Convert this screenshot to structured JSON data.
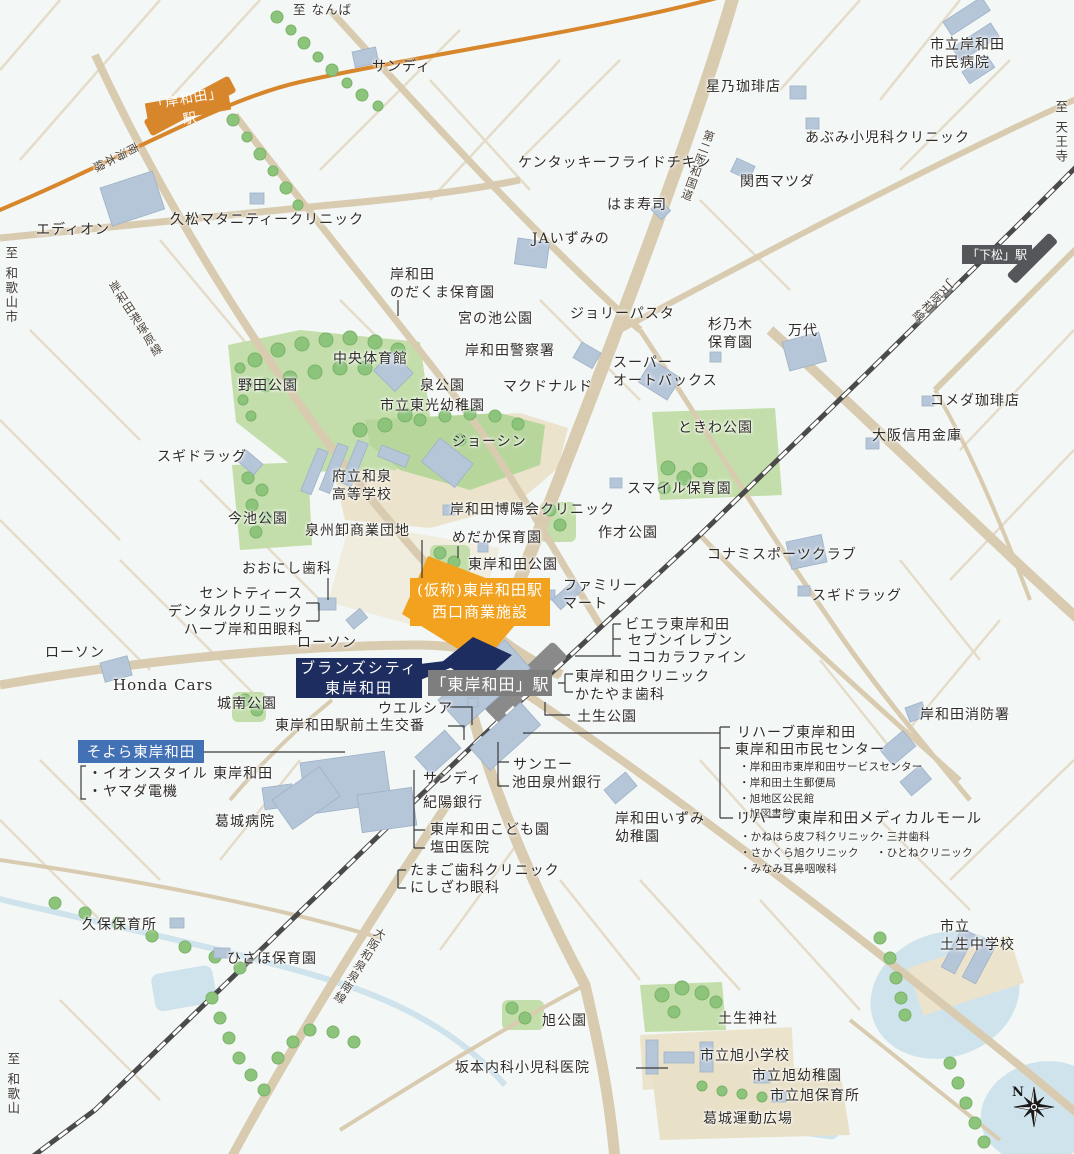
{
  "stations": {
    "kishiwada": "「岸和田」駅",
    "shimomatsu": "「下松」駅",
    "higashi_kishiwada": "「東岸和田」駅"
  },
  "highlights": {
    "project": "(仮称)東岸和田駅\n西口商業施設",
    "brands_city": "ブランズシティ\n東岸和田",
    "soyora": "そよら東岸和田"
  },
  "rail_lines": {
    "nankai": "南海本線",
    "jr_hanwa": "JR阪和線"
  },
  "road_names": {
    "daini_hanwa": "第二阪和国道",
    "kishiwada_kozuka": "岸和田港塚原線",
    "osaka_izumi_sennan": "大阪和泉泉南線"
  },
  "directions": {
    "namba": "至 なんば",
    "tennoji": "至 天王寺",
    "wakayama_city": "至 和歌山市",
    "wakayama": "至 和歌山"
  },
  "compass": {
    "north": "N"
  },
  "labels": {
    "sandy_north": "サンディ",
    "hoshino_coffee": "星乃珈琲店",
    "city_hospital": "市立岸和田\n市民病院",
    "abumi_clinic": "あぶみ小児科クリニック",
    "kentucky": "ケンタッキーフライドチキン",
    "kansai_matsuda": "関西マツダ",
    "hamazushi": "はま寿司",
    "ja_izumino": "JAいずみの",
    "edion": "エディオン",
    "hisamatsu_maternity": "久松マタニティークリニック",
    "nodakuma_hoikuen": "岸和田\nのだくま保育園",
    "miyanoike_park": "宮の池公園",
    "jolly_pasta": "ジョリーパスタ",
    "suginoki_hoikuen": "杉乃木\n保育園",
    "mandai": "万代",
    "chuo_gym": "中央体育館",
    "izumi_park": "泉公園",
    "toko_kindergarten": "市立東光幼稚園",
    "kishiwada_police": "岸和田警察署",
    "super_autobacs": "スーパー\nオートバックス",
    "mcdonalds": "マクドナルド",
    "noda_park": "野田公園",
    "joshin": "ジョーシン",
    "tokiwa_park": "ときわ公園",
    "komeda_coffee": "コメダ珈琲店",
    "osaka_shinkin": "大阪信用金庫",
    "sugi_drug_west": "スギドラッグ",
    "sugi_drug_east": "スギドラッグ",
    "izumi_high_school": "府立和泉\n高等学校",
    "imaike_park": "今池公園",
    "smile_hoikuen": "スマイル保育園",
    "hakuyokai_clinic": "岸和田博陽会クリニック",
    "senshu_oroshi": "泉州卸商業団地",
    "medaka_hoikuen": "めだか保育園",
    "sakusai_park": "作才公園",
    "higashi_kishiwada_park": "東岸和田公園",
    "konami_sports": "コナミスポーツクラブ",
    "oonishi_dental": "おおにし歯科",
    "cent_teeth_group": "セントティース\nデンタルクリニック\nハーブ岸和田眼科",
    "lawson_center": "ローソン",
    "family_mart": "ファミリー\nマート",
    "viera": "ビエラ東岸和田",
    "seven_eleven": "セブンイレブン",
    "cocokara_fine": "ココカラファイン",
    "hk_clinic": "東岸和田クリニック",
    "katayama_dental": "かたやま歯科",
    "habu_park": "土生公園",
    "welcia": "ウエルシア",
    "ekimae_koban": "東岸和田駅前土生交番",
    "lawson_west": "ローソン",
    "honda_cars": "Honda Cars",
    "jonan_park": "城南公園",
    "aeon_yamada": "・イオンスタイル 東岸和田\n・ヤマダ電機",
    "katsuragi_hospital": "葛城病院",
    "sandy_south": "サンディ",
    "kiyo_bank": "紀陽銀行",
    "sanei": "サンエー",
    "ikeda_senshu_bank": "池田泉州銀行",
    "kodomoen": "東岸和田こども園",
    "shioda_clinic": "塩田医院",
    "tamago_dental": "たまご歯科クリニック",
    "nishizawa_eye": "にしざわ眼科",
    "izumi_kindergarten": "岸和田いずみ\n幼稚園",
    "fire_department": "岸和田消防署",
    "rehab_hk": "リハーブ東岸和田",
    "shimin_center": "東岸和田市民センター",
    "shimin_center_list": "・岸和田市東岸和田サービスセンター\n・岸和田土生郵便局\n・旭地区公民館\n・旭図書館",
    "rehab_medical_mall": "リハーブ東岸和田メディカルモール",
    "mall_list_col1": "・かねはら皮フ科クリニック\n・さかくら旭クリニック\n・みなみ耳鼻咽喉科",
    "mall_list_col2": "・三井歯科\n・ひとねクリニック",
    "kubo_hoikusho": "久保保育所",
    "hisaho_hoikuen": "ひさほ保育園",
    "asahi_park": "旭公園",
    "sakamoto_clinic": "坂本内科小児科医院",
    "habu_shrine": "土生神社",
    "asahi_elementary": "市立旭小学校",
    "asahi_kindergarten": "市立旭幼稚園",
    "asahi_hoikusho": "市立旭保育所",
    "katsuragi_ground": "葛城運動広場",
    "habu_junior_high": "市立\n土生中学校"
  },
  "colors": {
    "background": "#f3f7f5",
    "road": "#d9cbb0",
    "park_green": "#c3deaa",
    "tree_green": "#8cc47c",
    "building_blue": "#b6c6d9",
    "water_blue": "#cfe3ed",
    "nankai_orange": "#d8862b",
    "project_orange": "#f2a21f",
    "brands_navy": "#1d2d5f",
    "soyora_blue": "#4371b5",
    "station_gray": "#7e7e7e",
    "shimomatsu_gray": "#55565a"
  }
}
